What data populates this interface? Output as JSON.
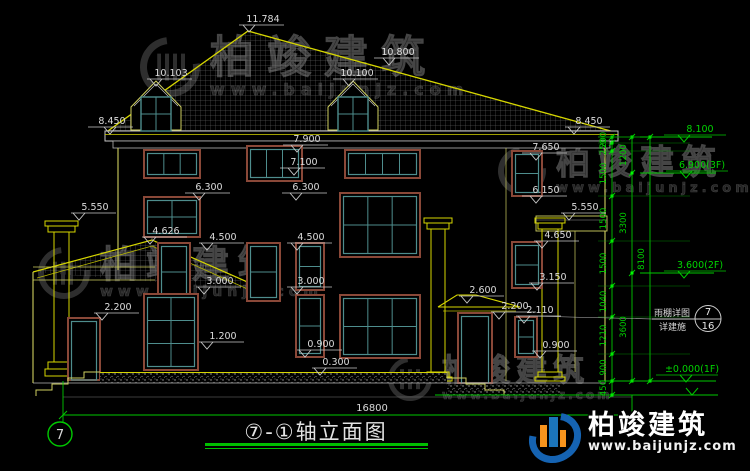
{
  "title": {
    "text": "⑦-①轴立面图"
  },
  "drawing": {
    "total_width_dim": "16800",
    "axis_bubble": "7",
    "elevation_marks": [
      "11.784",
      "10.103",
      "10.800",
      "10.100",
      "8.450",
      "8.450",
      "7.900",
      "7.650",
      "7.100",
      "6.300",
      "6.300",
      "6.150",
      "5.550",
      "5.550",
      "4.626",
      "4.500",
      "4.500",
      "4.650",
      "3.000",
      "3.000",
      "3.150",
      "2.600",
      "2.200",
      "2.200",
      "2.110",
      "1.200",
      "0.900",
      "0.900",
      "0.300"
    ],
    "right_levels": [
      "8.100",
      "6.900(3F)",
      "3.600(2F)",
      "±0.000(1F)"
    ],
    "chain_segments": [
      "200",
      "250",
      "1500",
      "1500",
      "1500",
      "1040",
      "1210",
      "900",
      "450"
    ],
    "story_dims": [
      "1200",
      "3300",
      "3600"
    ],
    "total_height_dim": "8100",
    "callout": {
      "line1": "雨棚详图",
      "line2": "详建施",
      "detail": "7",
      "sheet": "16"
    }
  },
  "watermark": {
    "brand": "柏竣建筑",
    "url": "www.baijunjz.com"
  },
  "logo": {
    "brand": "柏竣建筑",
    "url": "www.baijunjz.com"
  },
  "colors": {
    "line_yellow": "#d6d600",
    "dim_white": "#d8d8d8",
    "axis_green": "#00c800",
    "frame_brown": "#8a4838",
    "sash_teal": "#4e8d8d",
    "logo_blue": "#1563b2",
    "logo_orange": "#f7941d"
  }
}
